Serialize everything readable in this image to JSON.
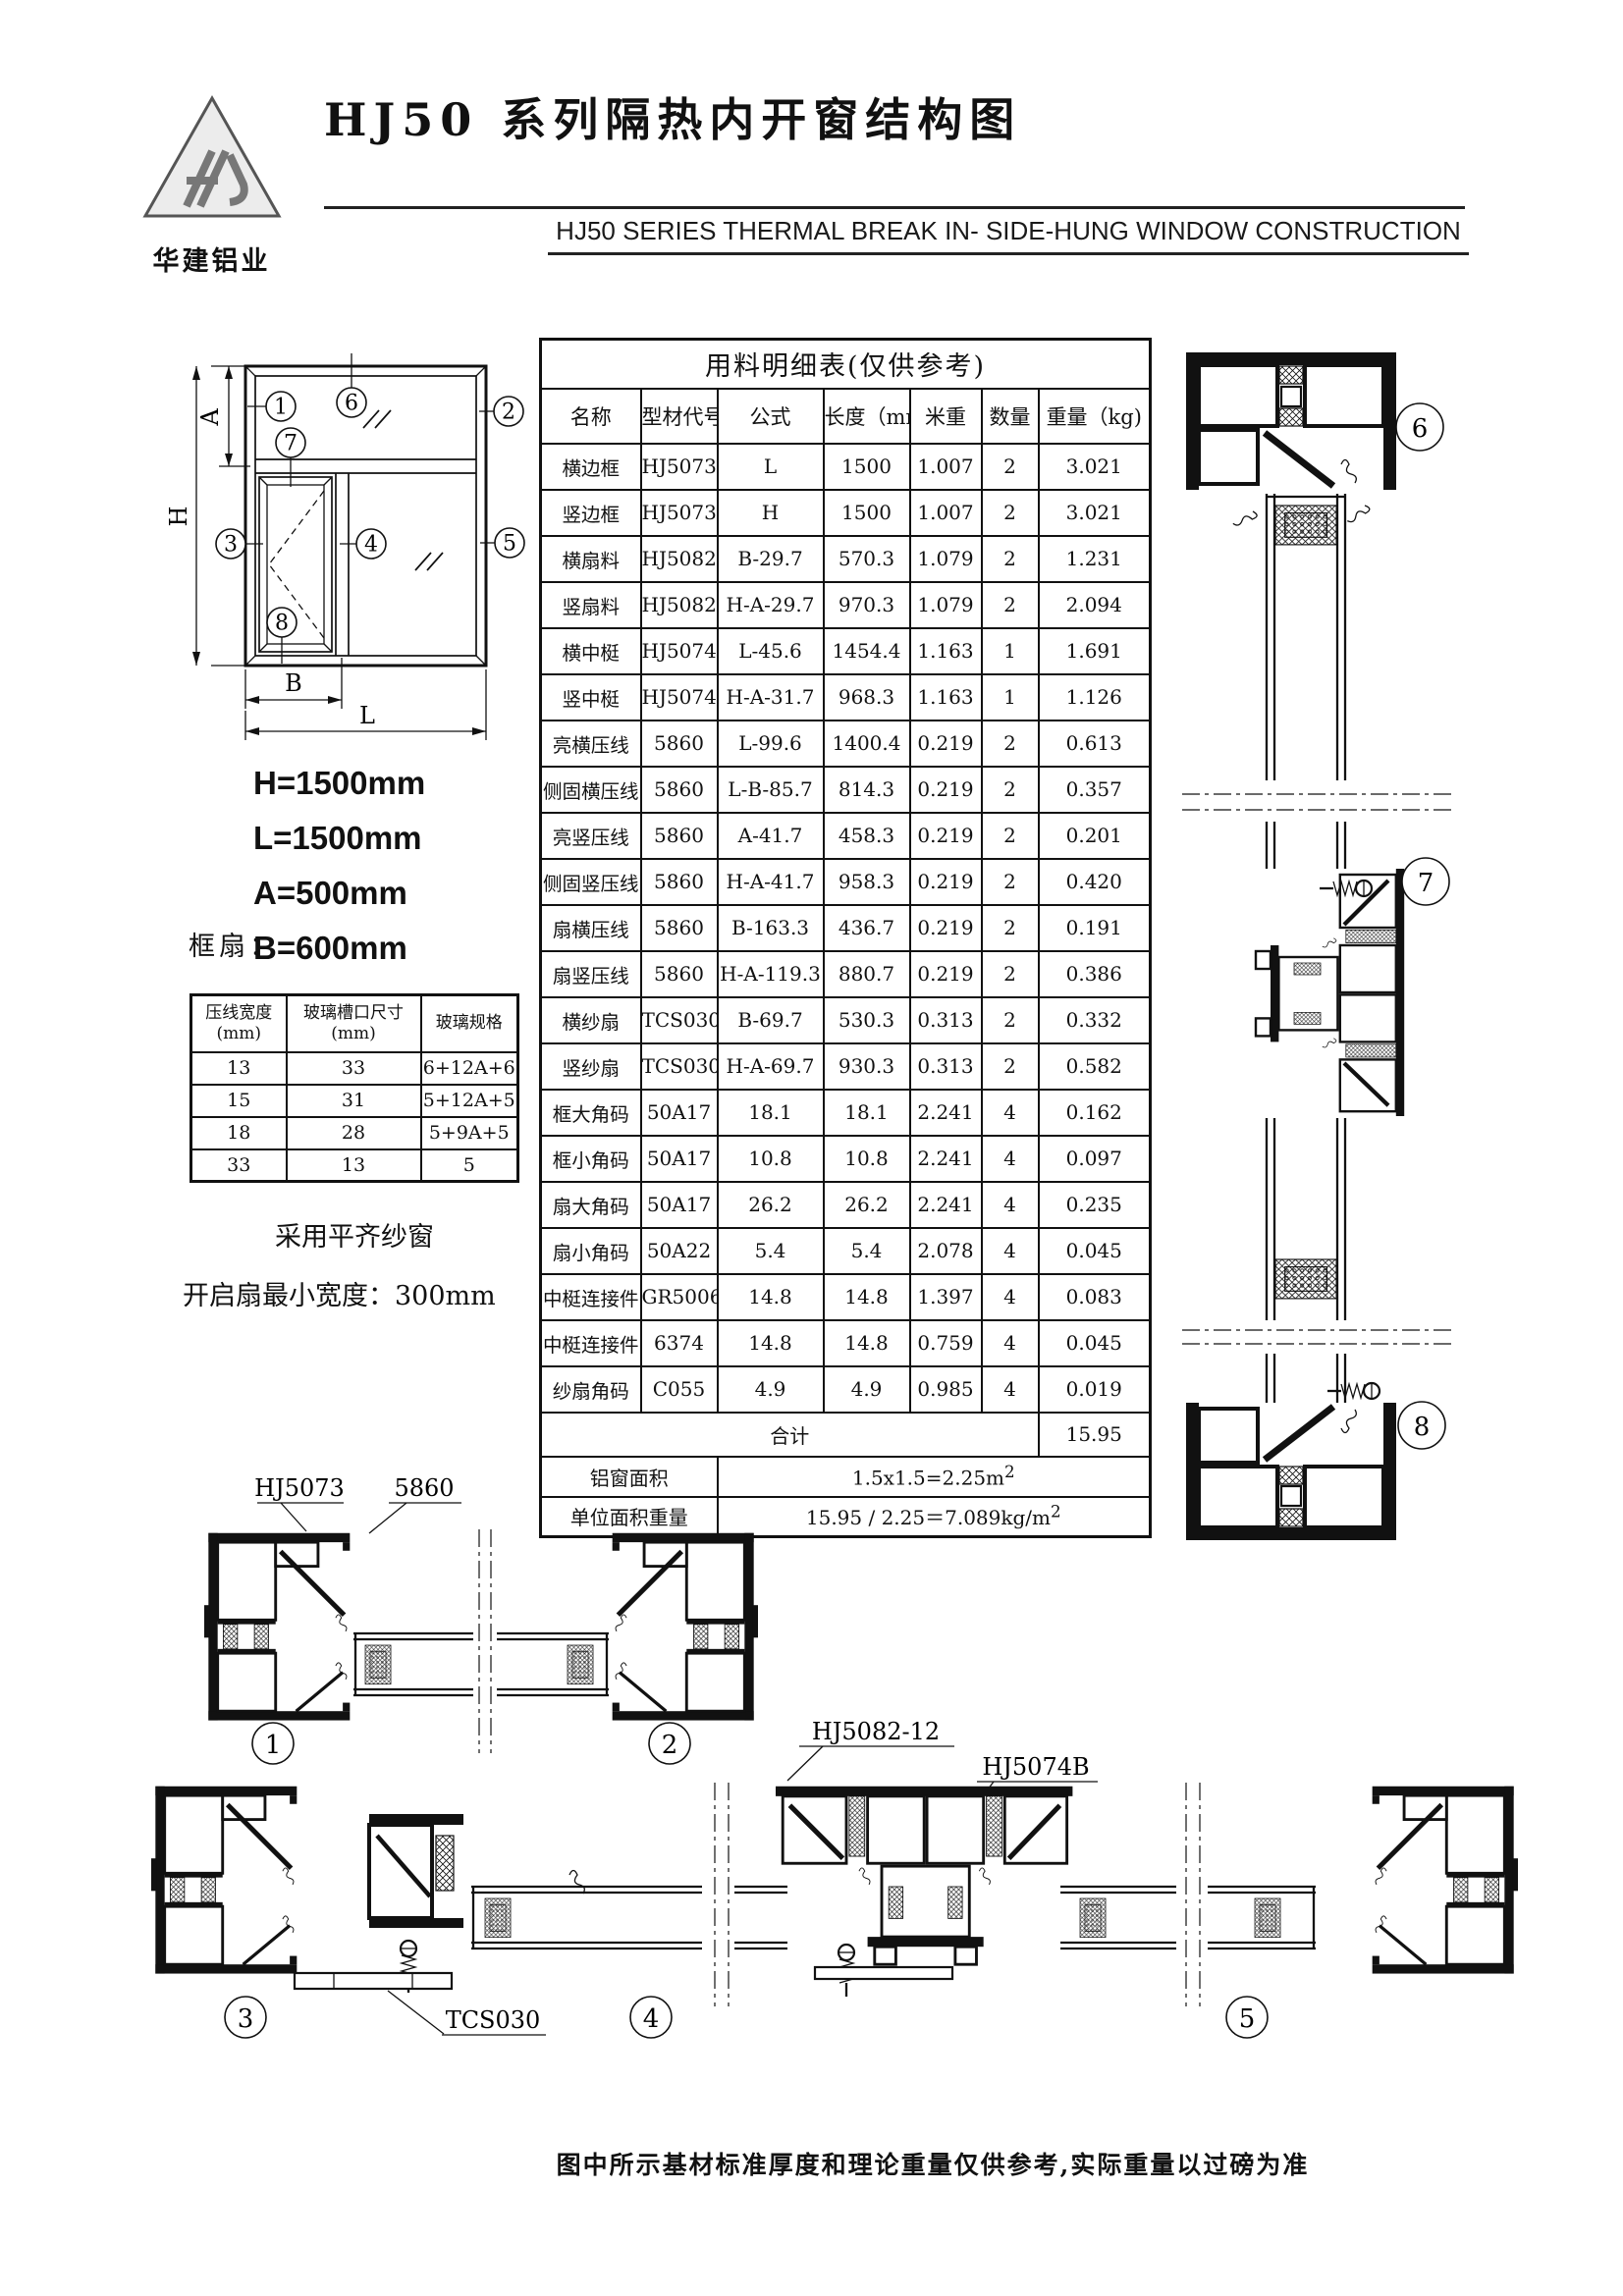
{
  "header": {
    "logo_text": "华建铝业",
    "title": "HJ50 系列隔热内开窗结构图",
    "subtitle": "HJ50 SERIES THERMAL BREAK IN- SIDE-HUNG WINDOW CONSTRUCTION"
  },
  "schematic": {
    "dim_h": "H",
    "dim_l": "L",
    "dim_a": "A",
    "dim_b": "B",
    "dims_text": [
      "H=1500mm",
      "L=1500mm",
      "A=500mm",
      "B=600mm"
    ]
  },
  "sections": {
    "numbers": [
      "1",
      "2",
      "3",
      "4",
      "5",
      "6",
      "7",
      "8"
    ],
    "part_labels": {
      "hj5073": "HJ5073",
      "p5860": "5860",
      "hj5082": "HJ5082-12",
      "hj5074b": "HJ5074B",
      "tcs030": "TCS030"
    }
  },
  "frame_sash": {
    "label": "框扇：",
    "headers": [
      [
        "压线宽度",
        "(mm)"
      ],
      [
        "玻璃槽口尺寸",
        "(mm)"
      ],
      [
        "玻璃规格",
        ""
      ]
    ],
    "rows": [
      [
        "13",
        "33",
        "6+12A+6"
      ],
      [
        "15",
        "31",
        "5+12A+5"
      ],
      [
        "18",
        "28",
        "5+9A+5"
      ],
      [
        "33",
        "13",
        "5"
      ]
    ],
    "notes": [
      "采用平齐纱窗",
      "开启扇最小宽度：300mm"
    ]
  },
  "materials": {
    "title": "用料明细表(仅供参考)",
    "headers": [
      "名称",
      "型材代号",
      "公式",
      "长度（mm)",
      "米重",
      "数量",
      "重量（kg)"
    ],
    "rows": [
      {
        "name": "横边框",
        "code": "HJ5073",
        "formula": "L",
        "length": "1500",
        "per_m": "1.007",
        "qty": "2",
        "weight": "3.021"
      },
      {
        "name": "竖边框",
        "code": "HJ5073",
        "formula": "H",
        "length": "1500",
        "per_m": "1.007",
        "qty": "2",
        "weight": "3.021"
      },
      {
        "name": "横扇料",
        "code": "HJ5082-12",
        "code_bold": true,
        "formula": "B-29.7",
        "length": "570.3",
        "per_m": "1.079",
        "qty": "2",
        "weight": "1.231"
      },
      {
        "name": "竖扇料",
        "code": "HJ5082-12",
        "code_bold": true,
        "formula": "H-A-29.7",
        "length": "970.3",
        "per_m": "1.079",
        "qty": "2",
        "weight": "2.094"
      },
      {
        "name": "横中梃",
        "code": "HJ5074B",
        "code_bold": true,
        "formula": "L-45.6",
        "length": "1454.4",
        "per_m": "1.163",
        "qty": "1",
        "weight": "1.691"
      },
      {
        "name": "竖中梃",
        "code": "HJ5074B",
        "code_bold": true,
        "formula": "H-A-31.7",
        "length": "968.3",
        "per_m": "1.163",
        "qty": "1",
        "weight": "1.126"
      },
      {
        "name": "亮横压线",
        "name_bold": true,
        "code": "5860",
        "formula": "L-99.6",
        "length": "1400.4",
        "per_m": "0.219",
        "qty": "2",
        "weight": "0.613"
      },
      {
        "name": "侧固横压线",
        "name_bold": true,
        "code": "5860",
        "formula": "L-B-85.7",
        "length": "814.3",
        "per_m": "0.219",
        "qty": "2",
        "weight": "0.357"
      },
      {
        "name": "亮竖压线",
        "code": "5860",
        "formula": "A-41.7",
        "length": "458.3",
        "per_m": "0.219",
        "qty": "2",
        "weight": "0.201"
      },
      {
        "name": "侧固竖压线",
        "name_bold": true,
        "code": "5860",
        "formula": "H-A-41.7",
        "length": "958.3",
        "per_m": "0.219",
        "qty": "2",
        "weight": "0.420"
      },
      {
        "name": "扇横压线",
        "code": "5860",
        "formula": "B-163.3",
        "length": "436.7",
        "per_m": "0.219",
        "qty": "2",
        "weight": "0.191"
      },
      {
        "name": "扇竖压线",
        "code": "5860",
        "formula": "H-A-119.3",
        "length": "880.7",
        "per_m": "0.219",
        "qty": "2",
        "weight": "0.386"
      },
      {
        "name": "横纱扇",
        "code": "TCS030",
        "formula": "B-69.7",
        "length": "530.3",
        "per_m": "0.313",
        "qty": "2",
        "weight": "0.332"
      },
      {
        "name": "竖纱扇",
        "code": "TCS030",
        "formula": "H-A-69.7",
        "length": "930.3",
        "per_m": "0.313",
        "qty": "2",
        "weight": "0.582"
      },
      {
        "name": "框大角码",
        "code": "50A17",
        "formula": "18.1",
        "length": "18.1",
        "per_m": "2.241",
        "qty": "4",
        "weight": "0.162"
      },
      {
        "name": "框小角码",
        "code": "50A17",
        "formula": "10.8",
        "length": "10.8",
        "per_m": "2.241",
        "qty": "4",
        "weight": "0.097"
      },
      {
        "name": "扇大角码",
        "code": "50A17",
        "formula": "26.2",
        "length": "26.2",
        "per_m": "2.241",
        "qty": "4",
        "weight": "0.235"
      },
      {
        "name": "扇小角码",
        "code": "50A22",
        "formula": "5.4",
        "length": "5.4",
        "per_m": "2.078",
        "qty": "4",
        "weight": "0.045"
      },
      {
        "name": "中梃连接件",
        "name_bold": true,
        "code": "GR5006",
        "formula": "14.8",
        "length": "14.8",
        "per_m": "1.397",
        "qty": "4",
        "weight": "0.083"
      },
      {
        "name": "中梃连接件",
        "name_bold": true,
        "code": "6374",
        "formula": "14.8",
        "length": "14.8",
        "per_m": "0.759",
        "qty": "4",
        "weight": "0.045"
      },
      {
        "name": "纱扇角码",
        "code": "C055",
        "formula": "4.9",
        "length": "4.9",
        "per_m": "0.985",
        "qty": "4",
        "weight": "0.019"
      }
    ],
    "total_label": "合计",
    "total_value": "15.95",
    "area_label": "铝窗面积",
    "area_value": "1.5x1.5=2.25m",
    "area_sup": "2",
    "unit_weight_label": "单位面积重量",
    "unit_weight_value": "15.95 / 2.25＝7.089kg/m",
    "unit_weight_sup": "2"
  },
  "footer": {
    "note": "图中所示基材标准厚度和理论重量仅供参考,实际重量以过磅为准"
  }
}
